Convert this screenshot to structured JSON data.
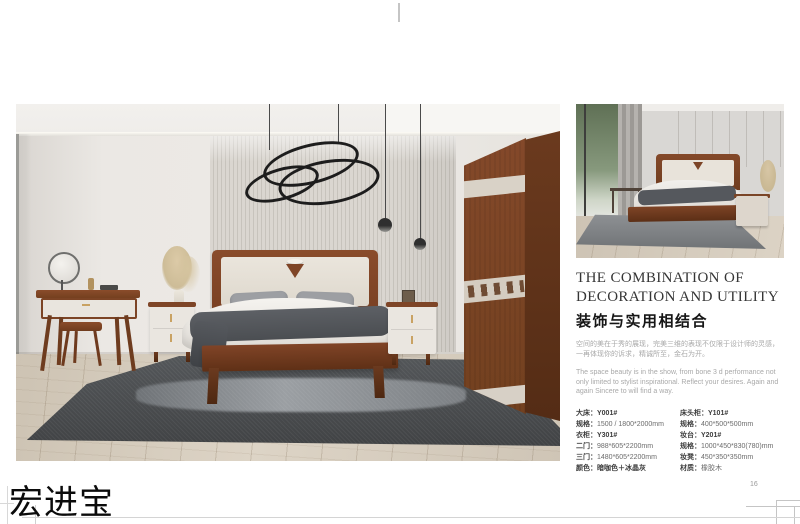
{
  "brand": {
    "name": "宏进宝"
  },
  "page": {
    "number": "16"
  },
  "photos": {
    "main_photo_alt": "bedroom-scene-wide",
    "small_photo_alt": "bedroom-scene-bed-closeup"
  },
  "colors": {
    "wood_accent": "#7c4426",
    "wall_gray": "#eae7e3",
    "rug_gray": "#4b4e51",
    "panel_cream": "#e8e3da"
  },
  "right_panel": {
    "title_line1": "THE COMBINATION OF",
    "title_line2": "DECORATION AND UTILITY",
    "subtitle": "装饰与实用相结合",
    "desc_cn": "空间的美在于秀的展现，完美三维的表现不仅限于设计师的灵感，一再体现你的诉求，精诚所至，金石为开。",
    "desc_en": "The space beauty is in the show, from bone 3 d performance not only limited to stylist inspirational. Reflect your desires. Again and again Sincere to will find a way.",
    "specs_left": [
      {
        "label": "大床：",
        "value": "Y001#"
      },
      {
        "label": "规格：",
        "value": "1500 / 1800*2000mm"
      },
      {
        "label": "衣柜：",
        "value": "Y301#"
      },
      {
        "label": "二门：",
        "value": "988*605*2200mm"
      },
      {
        "label": "三门：",
        "value": "1480*605*2200mm"
      },
      {
        "label": "颜色：",
        "value": "暗咖色＋冰晶灰"
      }
    ],
    "specs_right": [
      {
        "label": "床头柜：",
        "value": "Y101#"
      },
      {
        "label": "规格：",
        "value": "400*500*500mm"
      },
      {
        "label": "妆台：",
        "value": "Y201#"
      },
      {
        "label": "规格：",
        "value": "1000*450*830(780)mm"
      },
      {
        "label": "妆凳：",
        "value": "450*350*350mm"
      },
      {
        "label": "材质：",
        "value": "橡胶木"
      }
    ]
  }
}
